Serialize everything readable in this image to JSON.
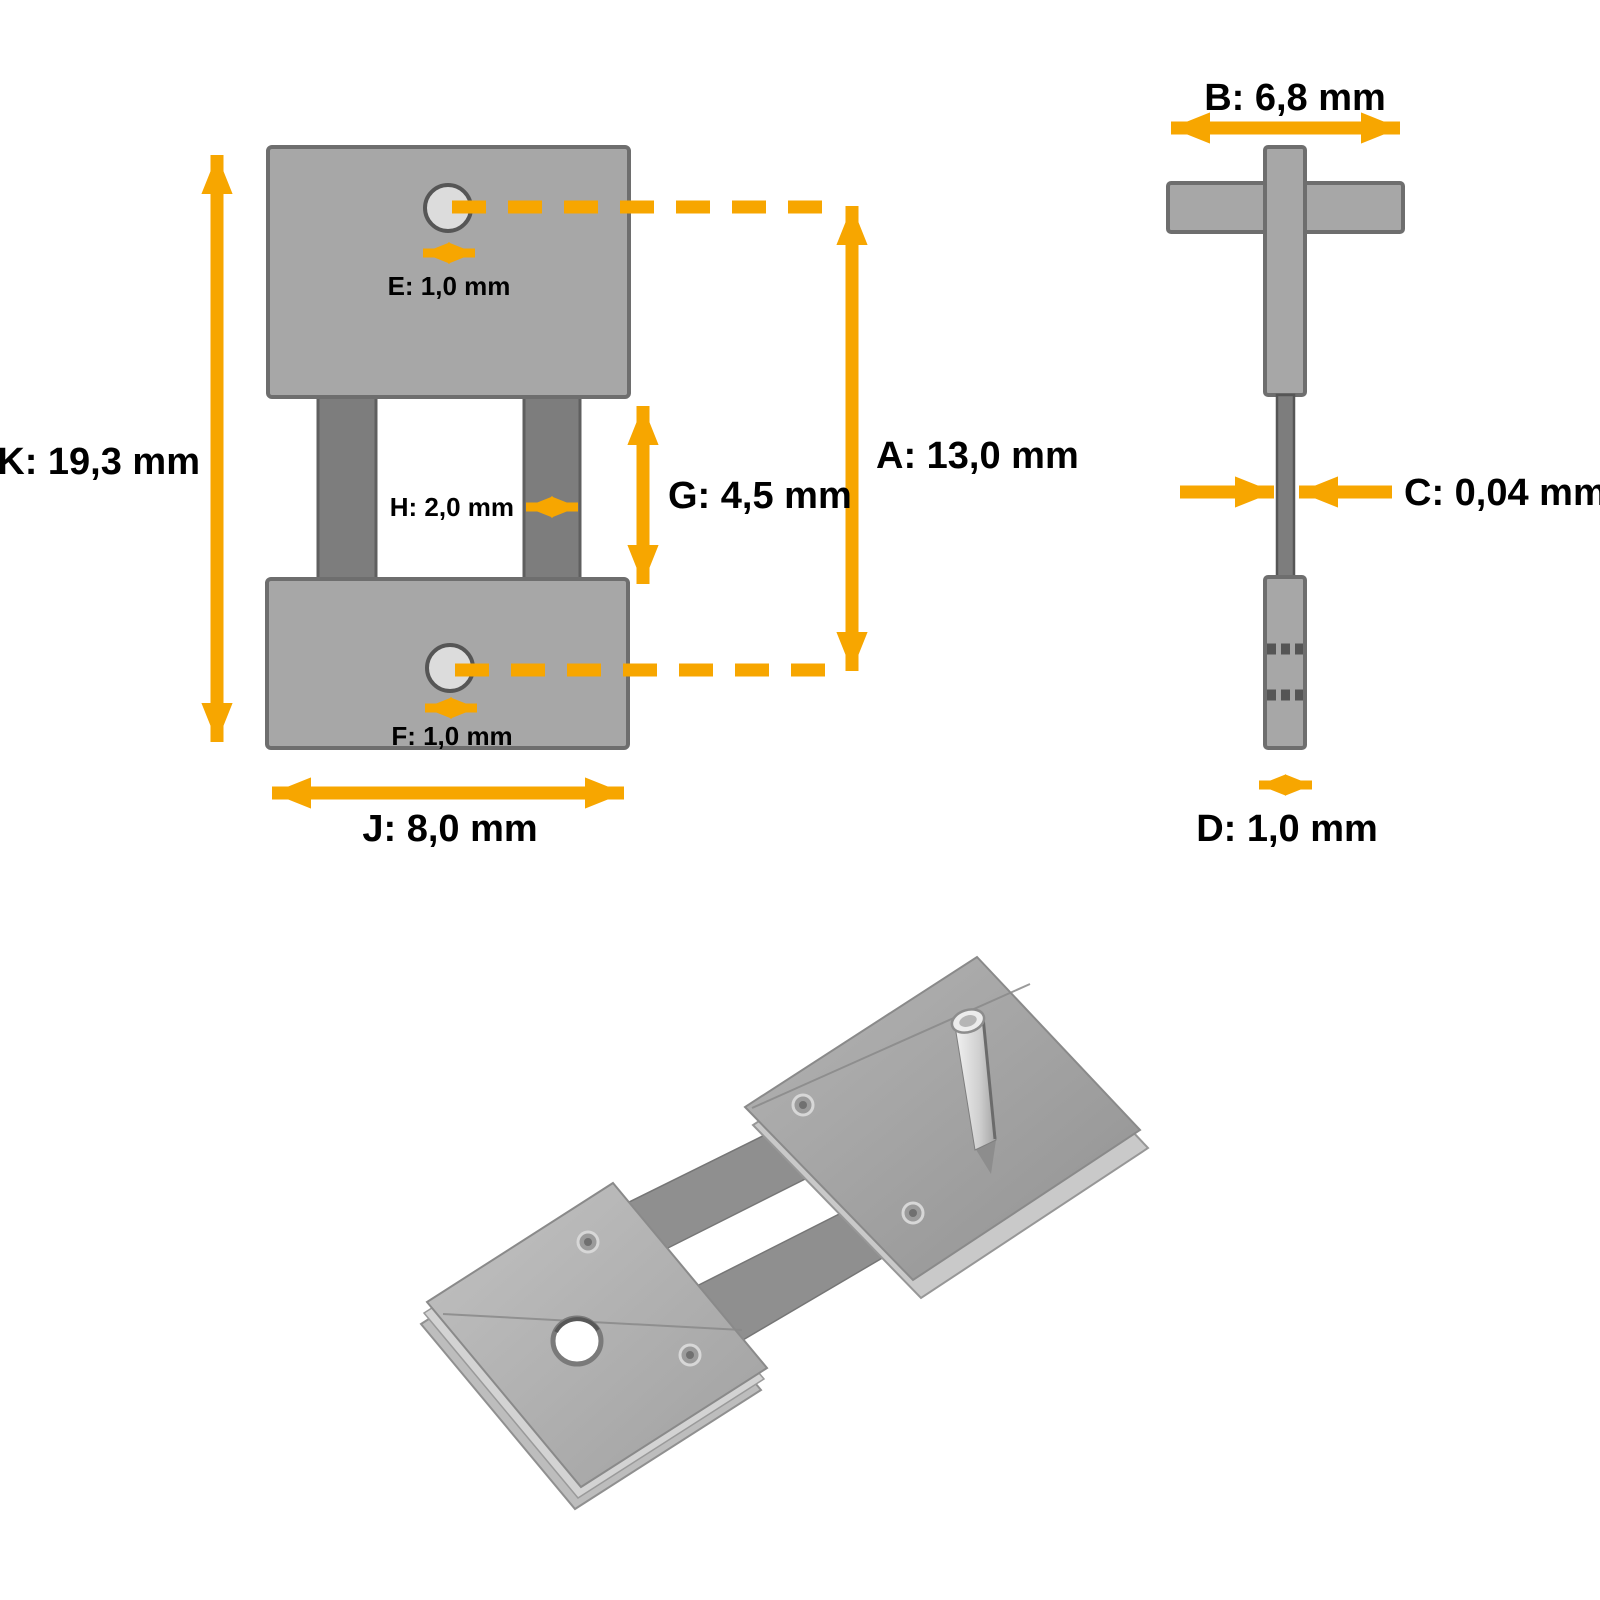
{
  "page": {
    "background": "#ffffff",
    "kind": "product dimension drawing"
  },
  "colors": {
    "arrow": "#F7A600",
    "block_fill": "#A7A7A7",
    "block_stroke": "#6E6E6E",
    "spring_leaf_fill": "#7D7D7D",
    "hole_fill": "#DCDCDC",
    "rivet_mark": "#555555",
    "text": "#000000"
  },
  "front_view": {
    "labels": {
      "K": "K: 19,3 mm",
      "E": "E: 1,0 mm",
      "H": "H: 2,0 mm",
      "G": "G: 4,5 mm",
      "A": "A: 13,0 mm",
      "F": "F: 1,0 mm",
      "J": "J: 8,0 mm"
    }
  },
  "side_view": {
    "labels": {
      "B": "B: 6,8 mm",
      "C": "C: 0,04 mm",
      "D": "D: 1,0 mm"
    }
  },
  "dimensions": [
    {
      "letter": "A",
      "value": "13,0",
      "unit": "mm",
      "view": "front"
    },
    {
      "letter": "B",
      "value": "6,8",
      "unit": "mm",
      "view": "side"
    },
    {
      "letter": "C",
      "value": "0,04",
      "unit": "mm",
      "view": "side"
    },
    {
      "letter": "D",
      "value": "1,0",
      "unit": "mm",
      "view": "side"
    },
    {
      "letter": "E",
      "value": "1,0",
      "unit": "mm",
      "view": "front"
    },
    {
      "letter": "F",
      "value": "1,0",
      "unit": "mm",
      "view": "front"
    },
    {
      "letter": "G",
      "value": "4,5",
      "unit": "mm",
      "view": "front"
    },
    {
      "letter": "H",
      "value": "2,0",
      "unit": "mm",
      "view": "front"
    },
    {
      "letter": "J",
      "value": "8,0",
      "unit": "mm",
      "view": "front"
    },
    {
      "letter": "K",
      "value": "19,3",
      "unit": "mm",
      "view": "front"
    }
  ],
  "photo": {
    "alt": "metal clock pendulum suspension spring part"
  }
}
